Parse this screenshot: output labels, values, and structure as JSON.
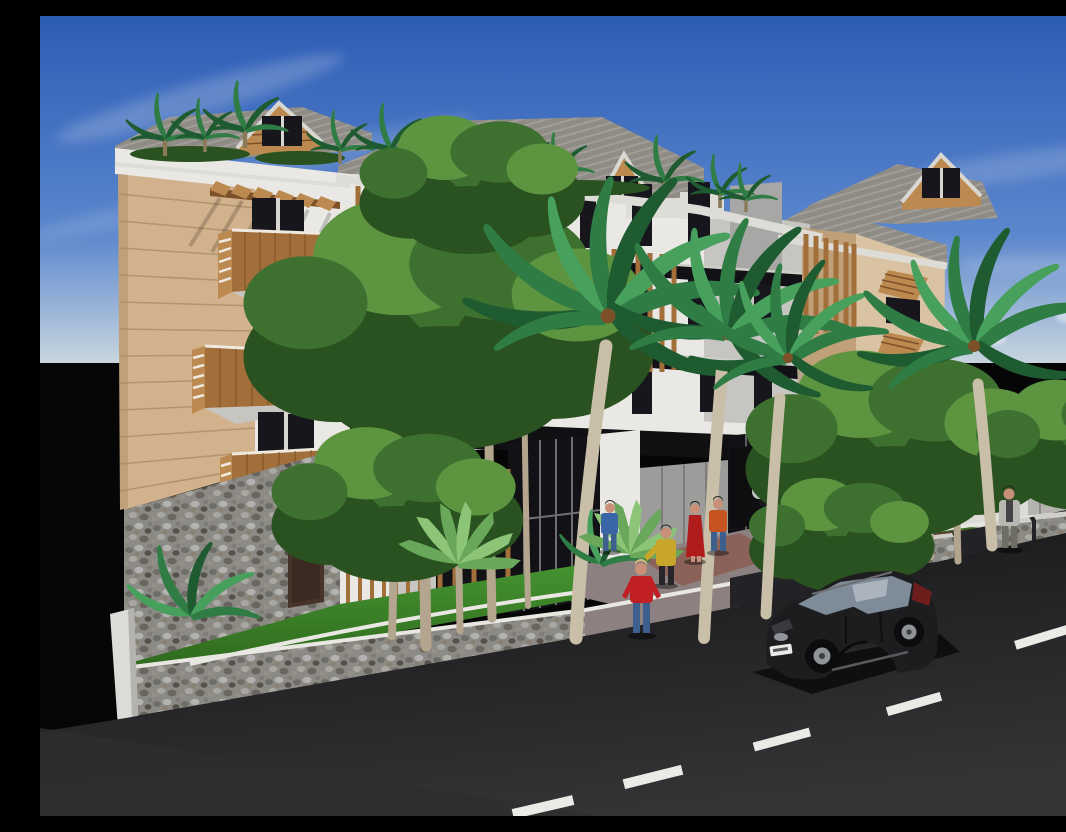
{
  "scene": {
    "title": "Daytime 3D architectural rendering of a tropical four-storey apartment building seen from the street",
    "type": "3d-architectural-rendering",
    "time_of_day": "day",
    "sky": {
      "label": "blue sky with wispy clouds",
      "clouds": "thin diagonal streaks top-left and right, small puffs near the horizon"
    },
    "building": {
      "label": "modern tropical apartment building",
      "storeys": 4,
      "roof": "grey corrugated metal roofs with white fascias and four wood-gabled dormer windows",
      "roof_garden": "small palms and hedges along the roof terraces",
      "left_wing": {
        "facade": "beige horizontal siding",
        "features": [
          "timber pergola with chevron brackets",
          "three timber balcony boxes with slatted ends",
          "dark window pairs",
          "dark brown entry door",
          "pebble-stone base wall"
        ]
      },
      "center": {
        "facade": "white render",
        "features": [
          "vertical timber brise-soleil screens",
          "dark glass balustrade bands",
          "stepped parapet",
          "ground-floor glass storefront with grey garage doors",
          "timber-framed glass entry doors"
        ]
      },
      "right_wing": {
        "facade": "light beige render",
        "features": [
          "vertical timber screen",
          "timber awning shutters propped open",
          "carport with parked car",
          "timber gate fence"
        ]
      }
    },
    "site": {
      "label": "landscaped frontage",
      "elements": [
        "green lawns",
        "white winding garden paths",
        "pebble-stone retaining wall along sidewalk",
        "three pebble-stone piers",
        "white perimeter wall on the right",
        "brown walkway",
        "white curb wall at far left",
        "paved entry court"
      ]
    },
    "road": {
      "label": "dark asphalt street",
      "lane_markings": {
        "type": "dashed center line",
        "color": "white",
        "dash_count": 5
      }
    },
    "vehicles": [
      {
        "label": "black hatchback driving on the street",
        "color": "black",
        "license_plate": "white plate, text illegible"
      },
      {
        "label": "silver car parked in the carport",
        "color": "silver"
      }
    ],
    "people": [
      {
        "label": "woman in red t-shirt and jeans walking near the curb",
        "top": "red",
        "bottom": "blue jeans",
        "hair": "blonde"
      },
      {
        "label": "man in yellow jacket and dark trousers",
        "top": "yellow",
        "bottom": "dark"
      },
      {
        "label": "woman in long red dress",
        "top": "red dress",
        "bottom": "red dress"
      },
      {
        "label": "man in orange shirt and jeans",
        "top": "orange",
        "bottom": "blue jeans"
      },
      {
        "label": "man in blue shirt and jeans near agave",
        "top": "blue",
        "bottom": "blue jeans"
      },
      {
        "label": "man in light grey top standing on right sidewalk",
        "top": "light grey",
        "bottom": "grey-green"
      }
    ],
    "vegetation": {
      "label": "tropical planting",
      "large_palms": 4,
      "leafy_trees": "several green canopies in front of the facade",
      "agaves": 2,
      "shrub_palms": 2,
      "roof_palms": "row of small palms on the roof terraces"
    },
    "palette": {
      "sky_top": "#2d5cb5",
      "sky_mid": "#5b87cd",
      "sky_horizon": "#ccd8e0",
      "cloud": "#ffffff",
      "backdrop": "#060607",
      "roof": "#8f8c85",
      "fascia": "#dddcd6",
      "facade_white": "#e9e8e4",
      "facade_shadow": "#c6c5c1",
      "panel_gray": "#a7a7a5",
      "facade_tan": "#d2b28c",
      "facade_tan_shade": "#bfa078",
      "facade_tan_right": "#d9c3a3",
      "wood": "#a26e3a",
      "wood_light": "#bc8a50",
      "wood_dark": "#7c5128",
      "glass_dark": "#121216",
      "window_dark": "#16161c",
      "wall_white": "#dcdbd7",
      "wall_shade": "#b4b3af",
      "lawn": "#275a18",
      "lawn_light": "#459330",
      "path_white": "#e8e7e2",
      "paving": "#8d8080",
      "paving_red": "#8a564a",
      "walkway_brown": "#5b4030",
      "road": "#161618",
      "road_light": "#343436",
      "lane": "#eceae6",
      "trunk": "#b4a68e",
      "palm_trunk": "#c9bfa8",
      "leaf": "#3e7030",
      "leaf_dark": "#2a5220",
      "leaf_light": "#5d9440",
      "palm": "#2f7d45",
      "palm_dark": "#1f5b31",
      "palm_light": "#47a05c",
      "agave": "#69a85a",
      "agave_light": "#8cc578",
      "car_black": "#1d1d20",
      "car_glass": "#7e8b98",
      "silver_car": "#bcbfc2",
      "skin": "#c89078",
      "hair_blonde": "#d8c07c",
      "person_red": "#c02024",
      "person_jeans": "#3d5f8e",
      "person_yellow": "#c7a62b",
      "person_dress_red": "#b01b1b",
      "person_orange": "#c65420",
      "person_blue": "#3a66a8",
      "person_gray": "#b9b7b2",
      "pants_dark": "#26262a",
      "stone_base": "#8b8a85"
    }
  }
}
